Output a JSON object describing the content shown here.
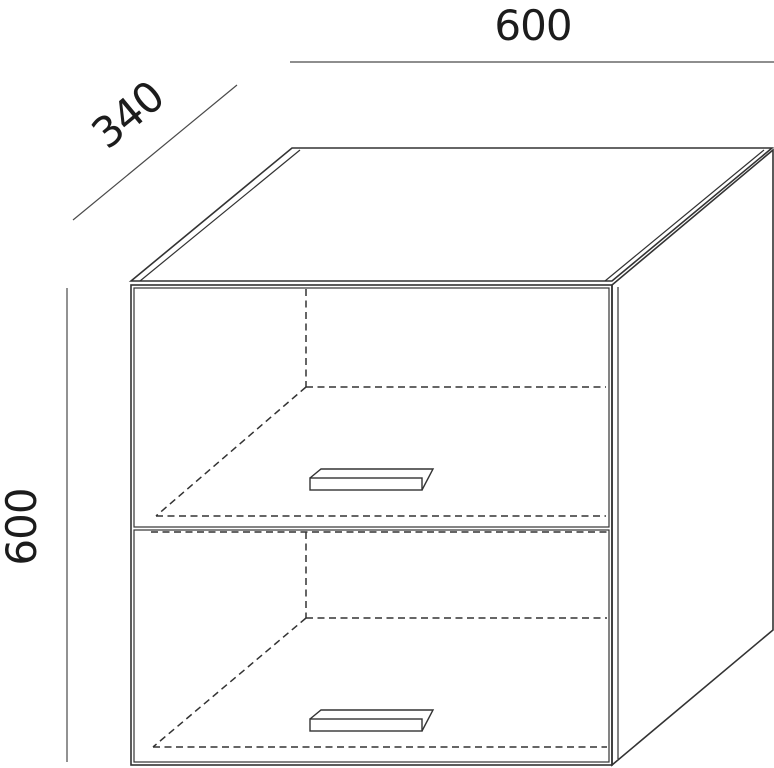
{
  "diagram": {
    "kind": "furniture-technical-drawing",
    "subject": "wall cabinet with two flap doors, isometric view",
    "background": "#ffffff",
    "line_color": "#333333",
    "dimension_line_color": "#4a4a4a",
    "text_color": "#1c1c1c",
    "dimensions": {
      "width_label": "600",
      "depth_label": "340",
      "height_label": "600"
    }
  }
}
